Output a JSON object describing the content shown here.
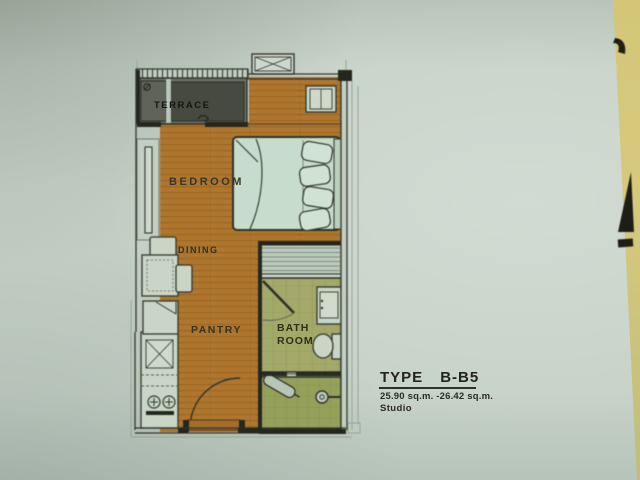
{
  "floor_plan": {
    "rooms": {
      "terrace": "TERRACE",
      "bedroom": "BEDROOM",
      "dining": "DINING",
      "pantry": "PANTRY",
      "bathroom_line1": "BATH",
      "bathroom_line2": "ROOM"
    },
    "title_block": {
      "type_label": "TYPE",
      "type_value": "B-B5",
      "area_range": "25.90 sq.m. -26.42 sq.m.",
      "unit_type": "Studio"
    },
    "colors": {
      "paper": "#c6d2c8",
      "desk": "#d3c677",
      "wood_floor": "#b2762b",
      "wood_line": "#8a5a21",
      "terrace_floor": "#6a6e63",
      "bath_floor": "#a4a968",
      "shower_floor": "#95a158",
      "bed_fill": "#c6dccb",
      "furniture_fill": "#c9d6c7",
      "wall_line": "#33362c",
      "wall_dark": "#24271f",
      "label_text": "#2b2d22"
    }
  }
}
